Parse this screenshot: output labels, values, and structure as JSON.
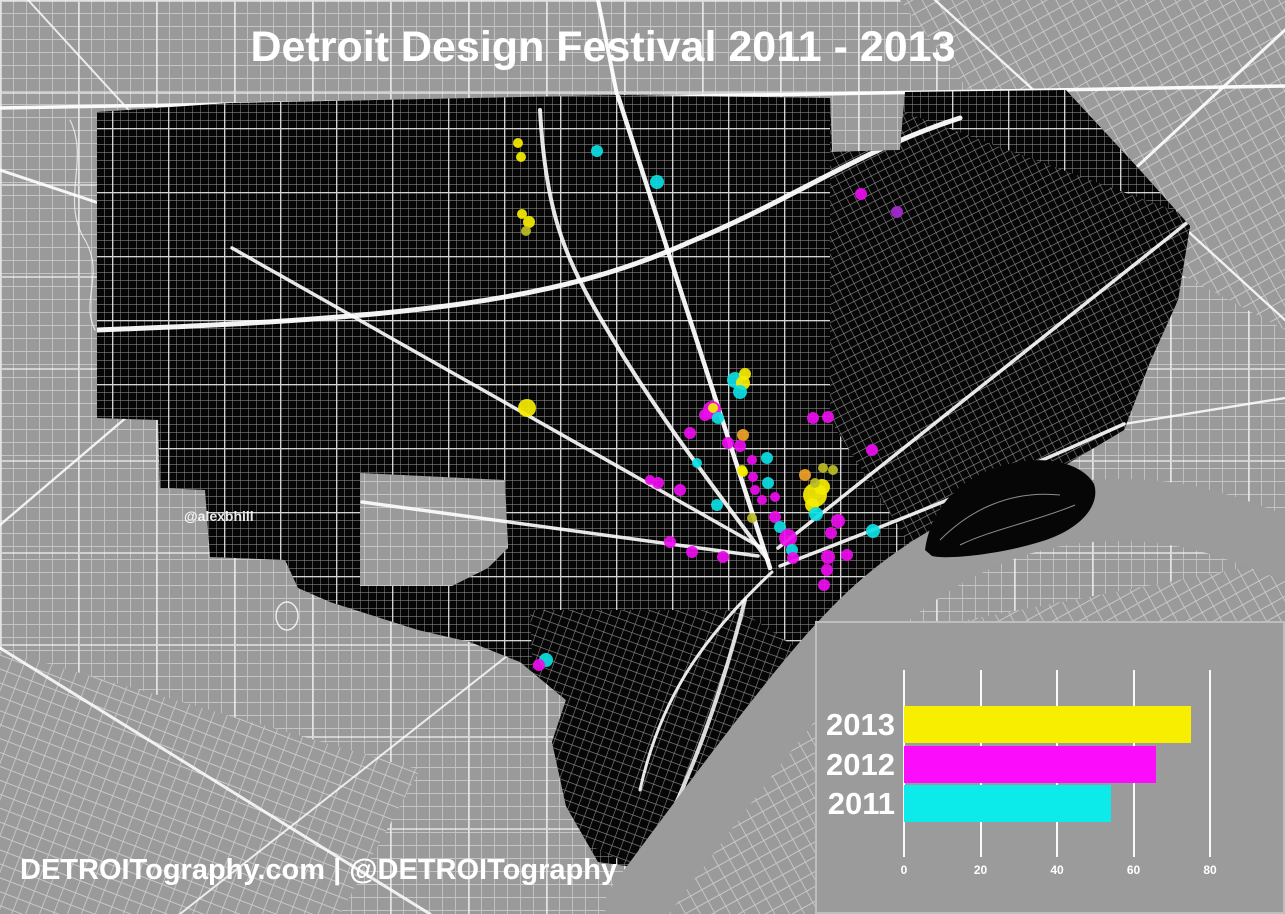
{
  "title": "Detroit Design Festival 2011 - 2013",
  "watermark": "@alexbhill",
  "footer": "DETROITography.com | @DETROITography",
  "map": {
    "background_color": "#9a9a9a",
    "city_color": "#060606",
    "street_color": "#ffffff",
    "palette": {
      "yellow": "#f6ed00",
      "magenta": "#ee0cee",
      "cyan": "#0cdfe4",
      "orange": "#f0a226",
      "olive": "#bcbe22",
      "purple": "#a62bd4"
    },
    "dots": [
      [
        518,
        143,
        5,
        "yellow"
      ],
      [
        521,
        157,
        5,
        "yellow"
      ],
      [
        597,
        151,
        6,
        "cyan"
      ],
      [
        657,
        182,
        7,
        "cyan"
      ],
      [
        861,
        194,
        6,
        "magenta"
      ],
      [
        897,
        212,
        6,
        "purple"
      ],
      [
        522,
        214,
        5,
        "yellow"
      ],
      [
        529,
        222,
        6,
        "yellow"
      ],
      [
        526,
        231,
        5,
        "olive"
      ],
      [
        527,
        408,
        9,
        "yellow"
      ],
      [
        735,
        380,
        8,
        "cyan"
      ],
      [
        743,
        383,
        7,
        "yellow"
      ],
      [
        740,
        392,
        7,
        "cyan"
      ],
      [
        745,
        374,
        6,
        "yellow"
      ],
      [
        712,
        410,
        9,
        "magenta"
      ],
      [
        713,
        408,
        5,
        "yellow"
      ],
      [
        705,
        415,
        6,
        "magenta"
      ],
      [
        718,
        418,
        6,
        "cyan"
      ],
      [
        690,
        433,
        6,
        "magenta"
      ],
      [
        728,
        443,
        6,
        "magenta"
      ],
      [
        743,
        435,
        6,
        "orange"
      ],
      [
        740,
        446,
        6,
        "magenta"
      ],
      [
        767,
        458,
        6,
        "cyan"
      ],
      [
        658,
        483,
        6,
        "magenta"
      ],
      [
        680,
        490,
        6,
        "magenta"
      ],
      [
        650,
        480,
        5,
        "magenta"
      ],
      [
        697,
        463,
        5,
        "cyan"
      ],
      [
        717,
        505,
        6,
        "cyan"
      ],
      [
        670,
        542,
        6,
        "magenta"
      ],
      [
        692,
        552,
        6,
        "magenta"
      ],
      [
        723,
        557,
        6,
        "magenta"
      ],
      [
        742,
        470,
        5,
        "yellow"
      ],
      [
        752,
        460,
        5,
        "magenta"
      ],
      [
        743,
        472,
        5,
        "yellow"
      ],
      [
        768,
        483,
        6,
        "cyan"
      ],
      [
        755,
        490,
        5,
        "magenta"
      ],
      [
        762,
        500,
        5,
        "magenta"
      ],
      [
        775,
        517,
        6,
        "magenta"
      ],
      [
        752,
        518,
        5,
        "olive"
      ],
      [
        780,
        527,
        6,
        "cyan"
      ],
      [
        788,
        538,
        9,
        "magenta"
      ],
      [
        792,
        550,
        6,
        "cyan"
      ],
      [
        793,
        558,
        6,
        "magenta"
      ],
      [
        813,
        418,
        6,
        "magenta"
      ],
      [
        828,
        417,
        6,
        "magenta"
      ],
      [
        805,
        475,
        6,
        "orange"
      ],
      [
        815,
        495,
        12,
        "yellow"
      ],
      [
        822,
        487,
        8,
        "yellow"
      ],
      [
        812,
        505,
        7,
        "yellow"
      ],
      [
        816,
        514,
        7,
        "cyan"
      ],
      [
        823,
        468,
        5,
        "olive"
      ],
      [
        833,
        470,
        5,
        "olive"
      ],
      [
        838,
        521,
        7,
        "magenta"
      ],
      [
        831,
        533,
        6,
        "magenta"
      ],
      [
        873,
        531,
        7,
        "cyan"
      ],
      [
        828,
        557,
        7,
        "magenta"
      ],
      [
        827,
        570,
        6,
        "magenta"
      ],
      [
        815,
        483,
        5,
        "olive"
      ],
      [
        872,
        450,
        6,
        "magenta"
      ],
      [
        753,
        477,
        5,
        "magenta"
      ],
      [
        775,
        497,
        5,
        "magenta"
      ],
      [
        546,
        660,
        7,
        "cyan"
      ],
      [
        539,
        665,
        6,
        "magenta"
      ],
      [
        847,
        555,
        6,
        "magenta"
      ],
      [
        824,
        585,
        6,
        "magenta"
      ]
    ]
  },
  "chart_data": {
    "type": "bar",
    "orientation": "horizontal",
    "categories": [
      "2013",
      "2012",
      "2011"
    ],
    "values": [
      75,
      66,
      54
    ],
    "colors": [
      "#f8ef00",
      "#fb0cfb",
      "#0ceaea"
    ],
    "xticks": [
      0,
      20,
      40,
      60,
      80
    ],
    "xlim": [
      0,
      98
    ],
    "title": "",
    "xlabel": "",
    "ylabel": "",
    "grid": "vertical-white-lines",
    "legend_position": "none",
    "panel_bg": "#9b9b9b"
  }
}
